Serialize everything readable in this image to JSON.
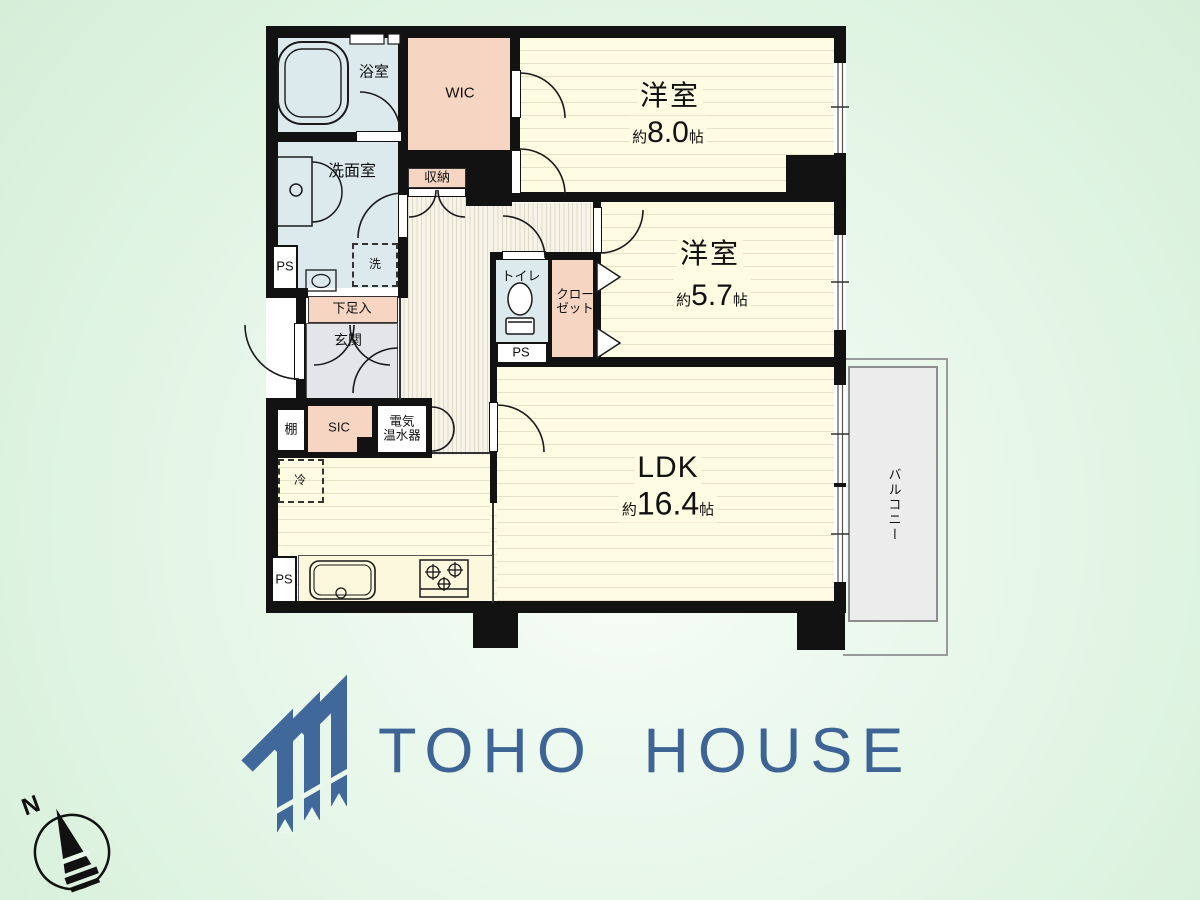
{
  "brand": {
    "logo_text": "TOHO HOUSE",
    "logo_color": "#3d6494"
  },
  "compass": {
    "north_label": "N"
  },
  "plan": {
    "rooms": [
      {
        "id": "bedroom-8",
        "name": "洋室",
        "size_prefix": "約",
        "size": "8.0",
        "size_unit": "帖"
      },
      {
        "id": "bedroom-57",
        "name": "洋室",
        "size_prefix": "約",
        "size": "5.7",
        "size_unit": "帖"
      },
      {
        "id": "ldk",
        "name": "LDK",
        "size_prefix": "約",
        "size": "16.4",
        "size_unit": "帖"
      }
    ],
    "labels": {
      "bath": "浴室",
      "washroom": "洗面室",
      "wic": "WIC",
      "storage": "収納",
      "toilet": "トイレ",
      "closet_line1": "クロー",
      "closet_line2": "ゼット",
      "shoe_box": "下足入",
      "entrance": "玄関",
      "shelf": "棚",
      "sic": "SIC",
      "water_heater_line1": "電気",
      "water_heater_line2": "温水器",
      "fridge": "冷",
      "laundry": "洗",
      "ps": "PS",
      "balcony": "バルコニー"
    }
  },
  "colors": {
    "wall": "#121212",
    "room_fill": "#fdfbe2",
    "room_stripe": "#e5e2c6",
    "wet_area": "#dceaee",
    "closet_peach": "#f6d5c2",
    "entrance_gray": "#e4e5e8",
    "hall_cream": "#f7f3e8",
    "balcony_gray": "#ececec",
    "background_green": "#ddf3e0",
    "logo_blue": "#3d6494"
  }
}
